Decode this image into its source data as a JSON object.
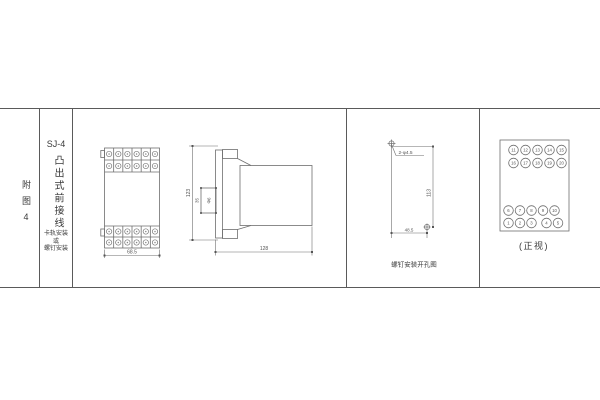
{
  "figure_column": {
    "label": "附图4"
  },
  "model_column": {
    "model": "SJ-4",
    "mounting_type": "凸出式前接线",
    "mount_note": "卡轨安装\n或\n螺钉安装"
  },
  "front_view": {
    "width_dim": "68.5"
  },
  "side_view": {
    "height_dim": "123",
    "bracket_width_dim": "35",
    "hole_dim": "Φ6",
    "depth_dim": "128"
  },
  "drill_view": {
    "holes_label": "2-φ4.5",
    "vertical_dim": "113",
    "horizontal_dim": "48.5",
    "caption": "螺钉安装开孔图"
  },
  "terminal_view": {
    "caption": "(正视)",
    "rows": {
      "top_outer": [
        "11",
        "12",
        "13",
        "14",
        "15"
      ],
      "top_inner": [
        "16",
        "17",
        "18",
        "19",
        "20"
      ],
      "bottom_inner": [
        "6",
        "7",
        "8",
        "9",
        "10"
      ],
      "bottom_outer": [
        "1",
        "2",
        "3",
        "4",
        "5"
      ]
    }
  }
}
